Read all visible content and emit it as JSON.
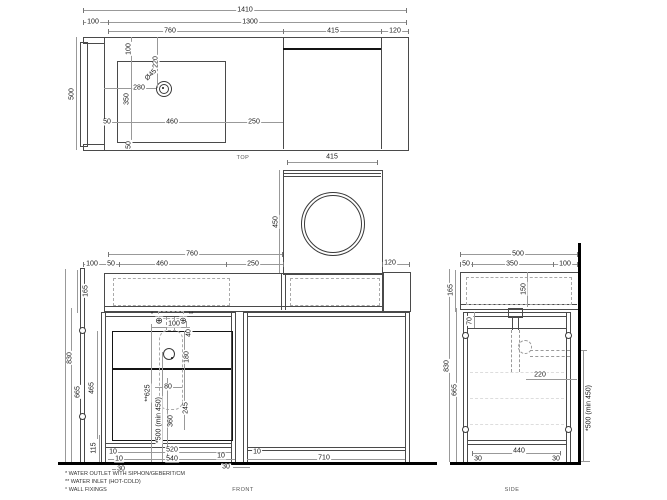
{
  "drawing_title": "vanity unit with washing machine bay - dimensioned views",
  "colors": {
    "object_line": "#4a4a4a",
    "heavy_line": "#141414",
    "dim_line": "#999999",
    "wall_floor": "#000000",
    "background": "#ffffff"
  },
  "glyphs": {
    "water_point": "⊕"
  },
  "top_view": {
    "name": "TOP",
    "d1410": "1410",
    "d100": "100",
    "d1300": "1300",
    "d760": "760",
    "d415": "415",
    "d120": "120",
    "d500": "500",
    "s100": "100",
    "s220": "220",
    "dia": "Ø45",
    "s280": "280",
    "s350": "350",
    "s50a": "50",
    "s460": "460",
    "s250": "250",
    "s50b": "50",
    "d415b": "415"
  },
  "washer_view": {
    "d450": "450"
  },
  "front_view": {
    "name": "FRONT",
    "d760": "760",
    "d100": "100",
    "d50": "50",
    "d460": "460",
    "d250": "250",
    "d120": "120",
    "d165": "165",
    "d830": "830",
    "d665": "665",
    "d465": "465",
    "d115": "115",
    "s100": "100",
    "s40": "40",
    "s180": "180",
    "s80": "80",
    "s245": "245",
    "s360": "360",
    "inlet_height": "**625",
    "outlet_height": "*500 (min 450)",
    "b10a": "10",
    "b10b": "10",
    "b30a": "30",
    "b520": "520",
    "b540": "540",
    "b10c": "10",
    "b10d": "10",
    "b30b": "30",
    "b710": "710",
    "ref_outlet": "*",
    "ref_inlet": "**"
  },
  "side_view": {
    "name": "SIDE",
    "d500": "500",
    "d50": "50",
    "d350": "350",
    "d100": "100",
    "d165": "165",
    "d150": "150",
    "d70": "70",
    "d830": "830",
    "d665": "665",
    "d220": "220",
    "d440": "440",
    "b30a": "30",
    "b30b": "30",
    "outlet_height": "*500 (min 450)"
  },
  "footnotes": [
    "* WATER OUTLET WITH SIPHON/GEBERIT/CM",
    "** WATER INLET (HOT-COLD)",
    "° WALL FIXINGS"
  ]
}
